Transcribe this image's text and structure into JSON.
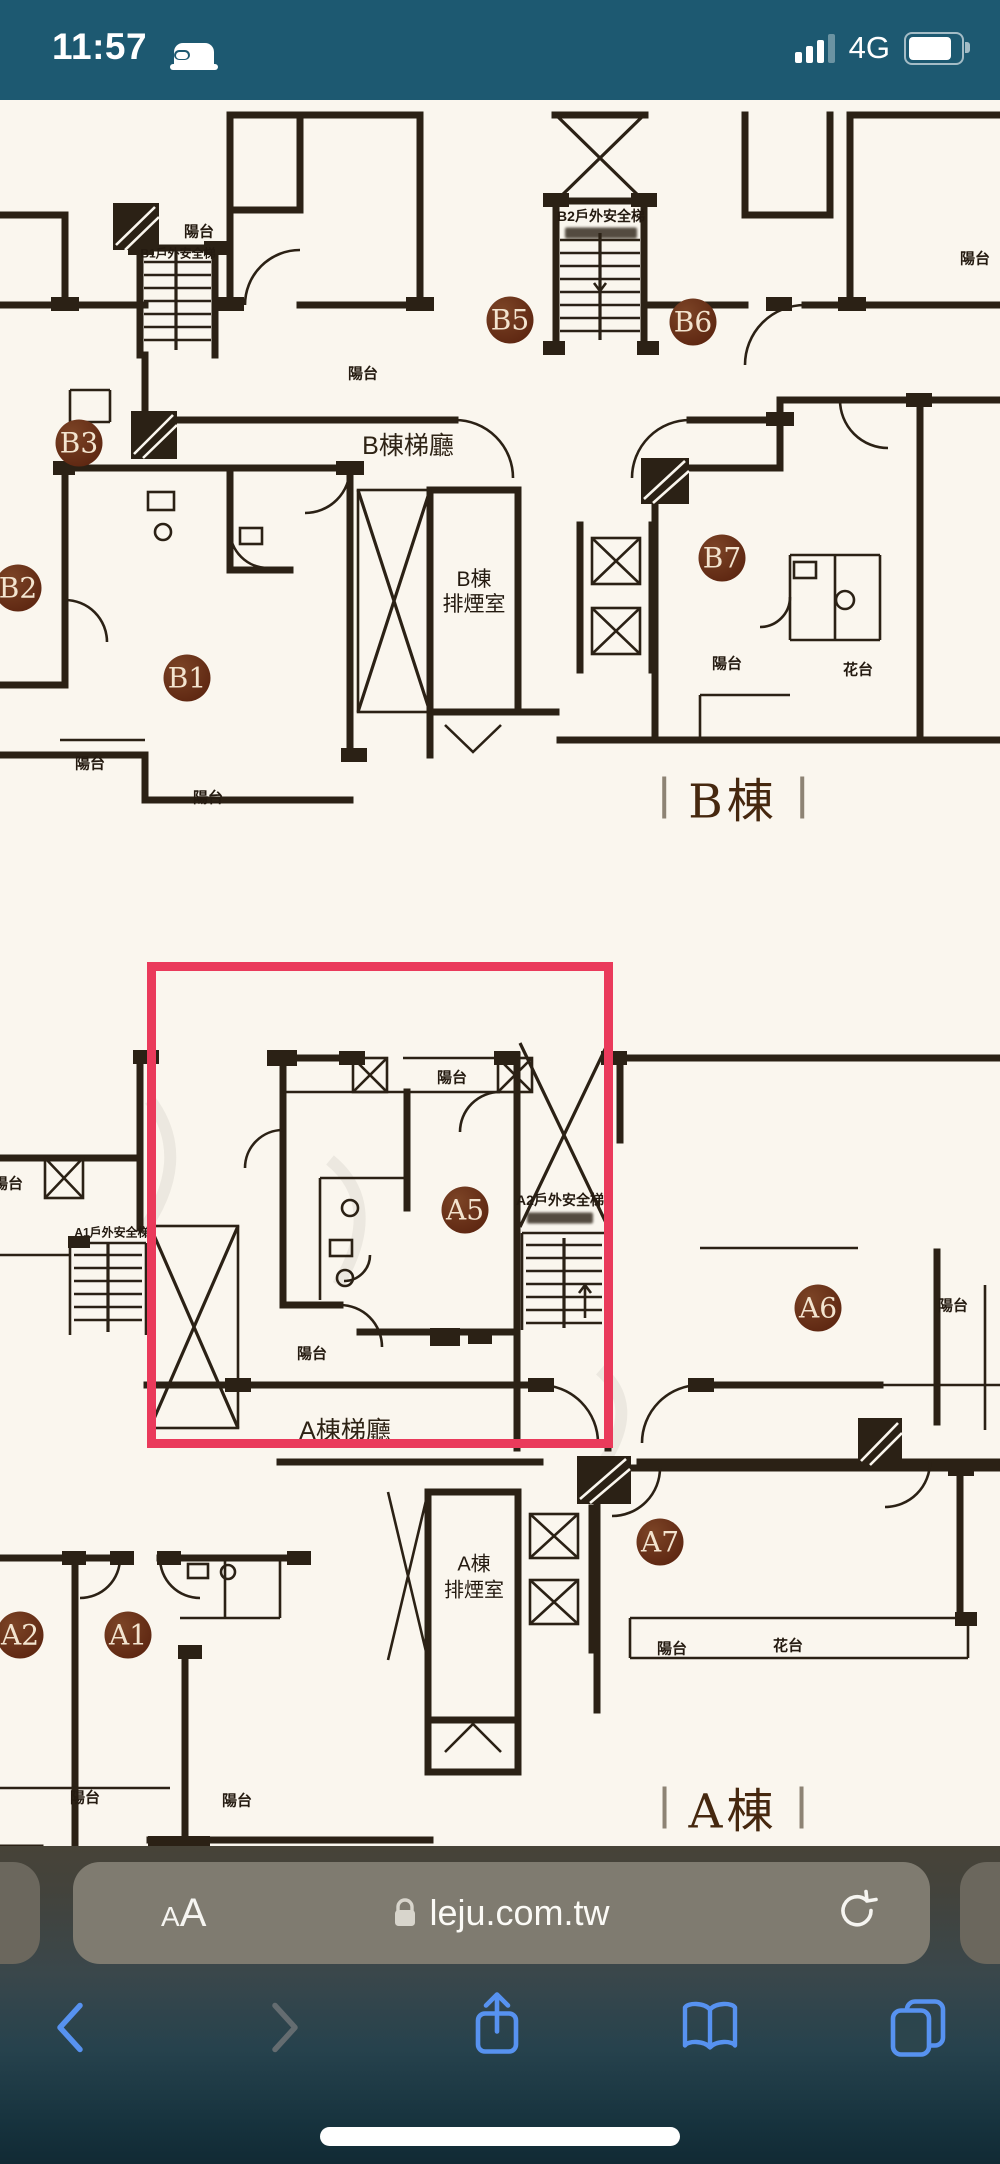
{
  "status_bar": {
    "time": "11:57",
    "network": "4G",
    "icons": [
      "bed-icon",
      "cellular-signal-icon",
      "battery-icon"
    ],
    "signal_bars_filled": 3,
    "signal_bars_total": 4
  },
  "plan": {
    "balcony": "陽台",
    "flower": "花台",
    "b": {
      "b1": "B1",
      "b2": "B2",
      "b3": "B3",
      "b5": "B5",
      "b6": "B6",
      "b7": "B7",
      "lobby": "B棟梯廳",
      "smoke1": "B棟",
      "smoke2": "排煙室",
      "stair2": "B2戶外安全梯",
      "stair1": "B1戶外安全梯",
      "wing": "B棟"
    },
    "a": {
      "a1": "A1",
      "a2": "A2",
      "a5": "A5",
      "a6": "A6",
      "a7": "A7",
      "lobby": "A棟梯廳",
      "smoke1": "A棟",
      "smoke2": "排煙室",
      "stair2": "A2戶外安全梯",
      "stair1": "A1戶外安全梯",
      "wing": "A棟"
    },
    "highlighted_unit": "A5"
  },
  "url_bar": {
    "reader": "AA",
    "domain": "leju.com.tw",
    "icons": [
      "lock-icon",
      "refresh-icon"
    ]
  },
  "toolbar": {
    "icons": [
      "back-icon",
      "forward-icon",
      "share-icon",
      "bookmarks-icon",
      "tabs-icon"
    ]
  },
  "colors": {
    "teal": "#1d5971",
    "red": "#ea3a5b",
    "wall": "#2b2115",
    "paper": "#faf6ee",
    "circle1": "#7c4426",
    "circle2": "#561f0c",
    "blue": "#5792f0",
    "pill": "#7f7b70"
  }
}
